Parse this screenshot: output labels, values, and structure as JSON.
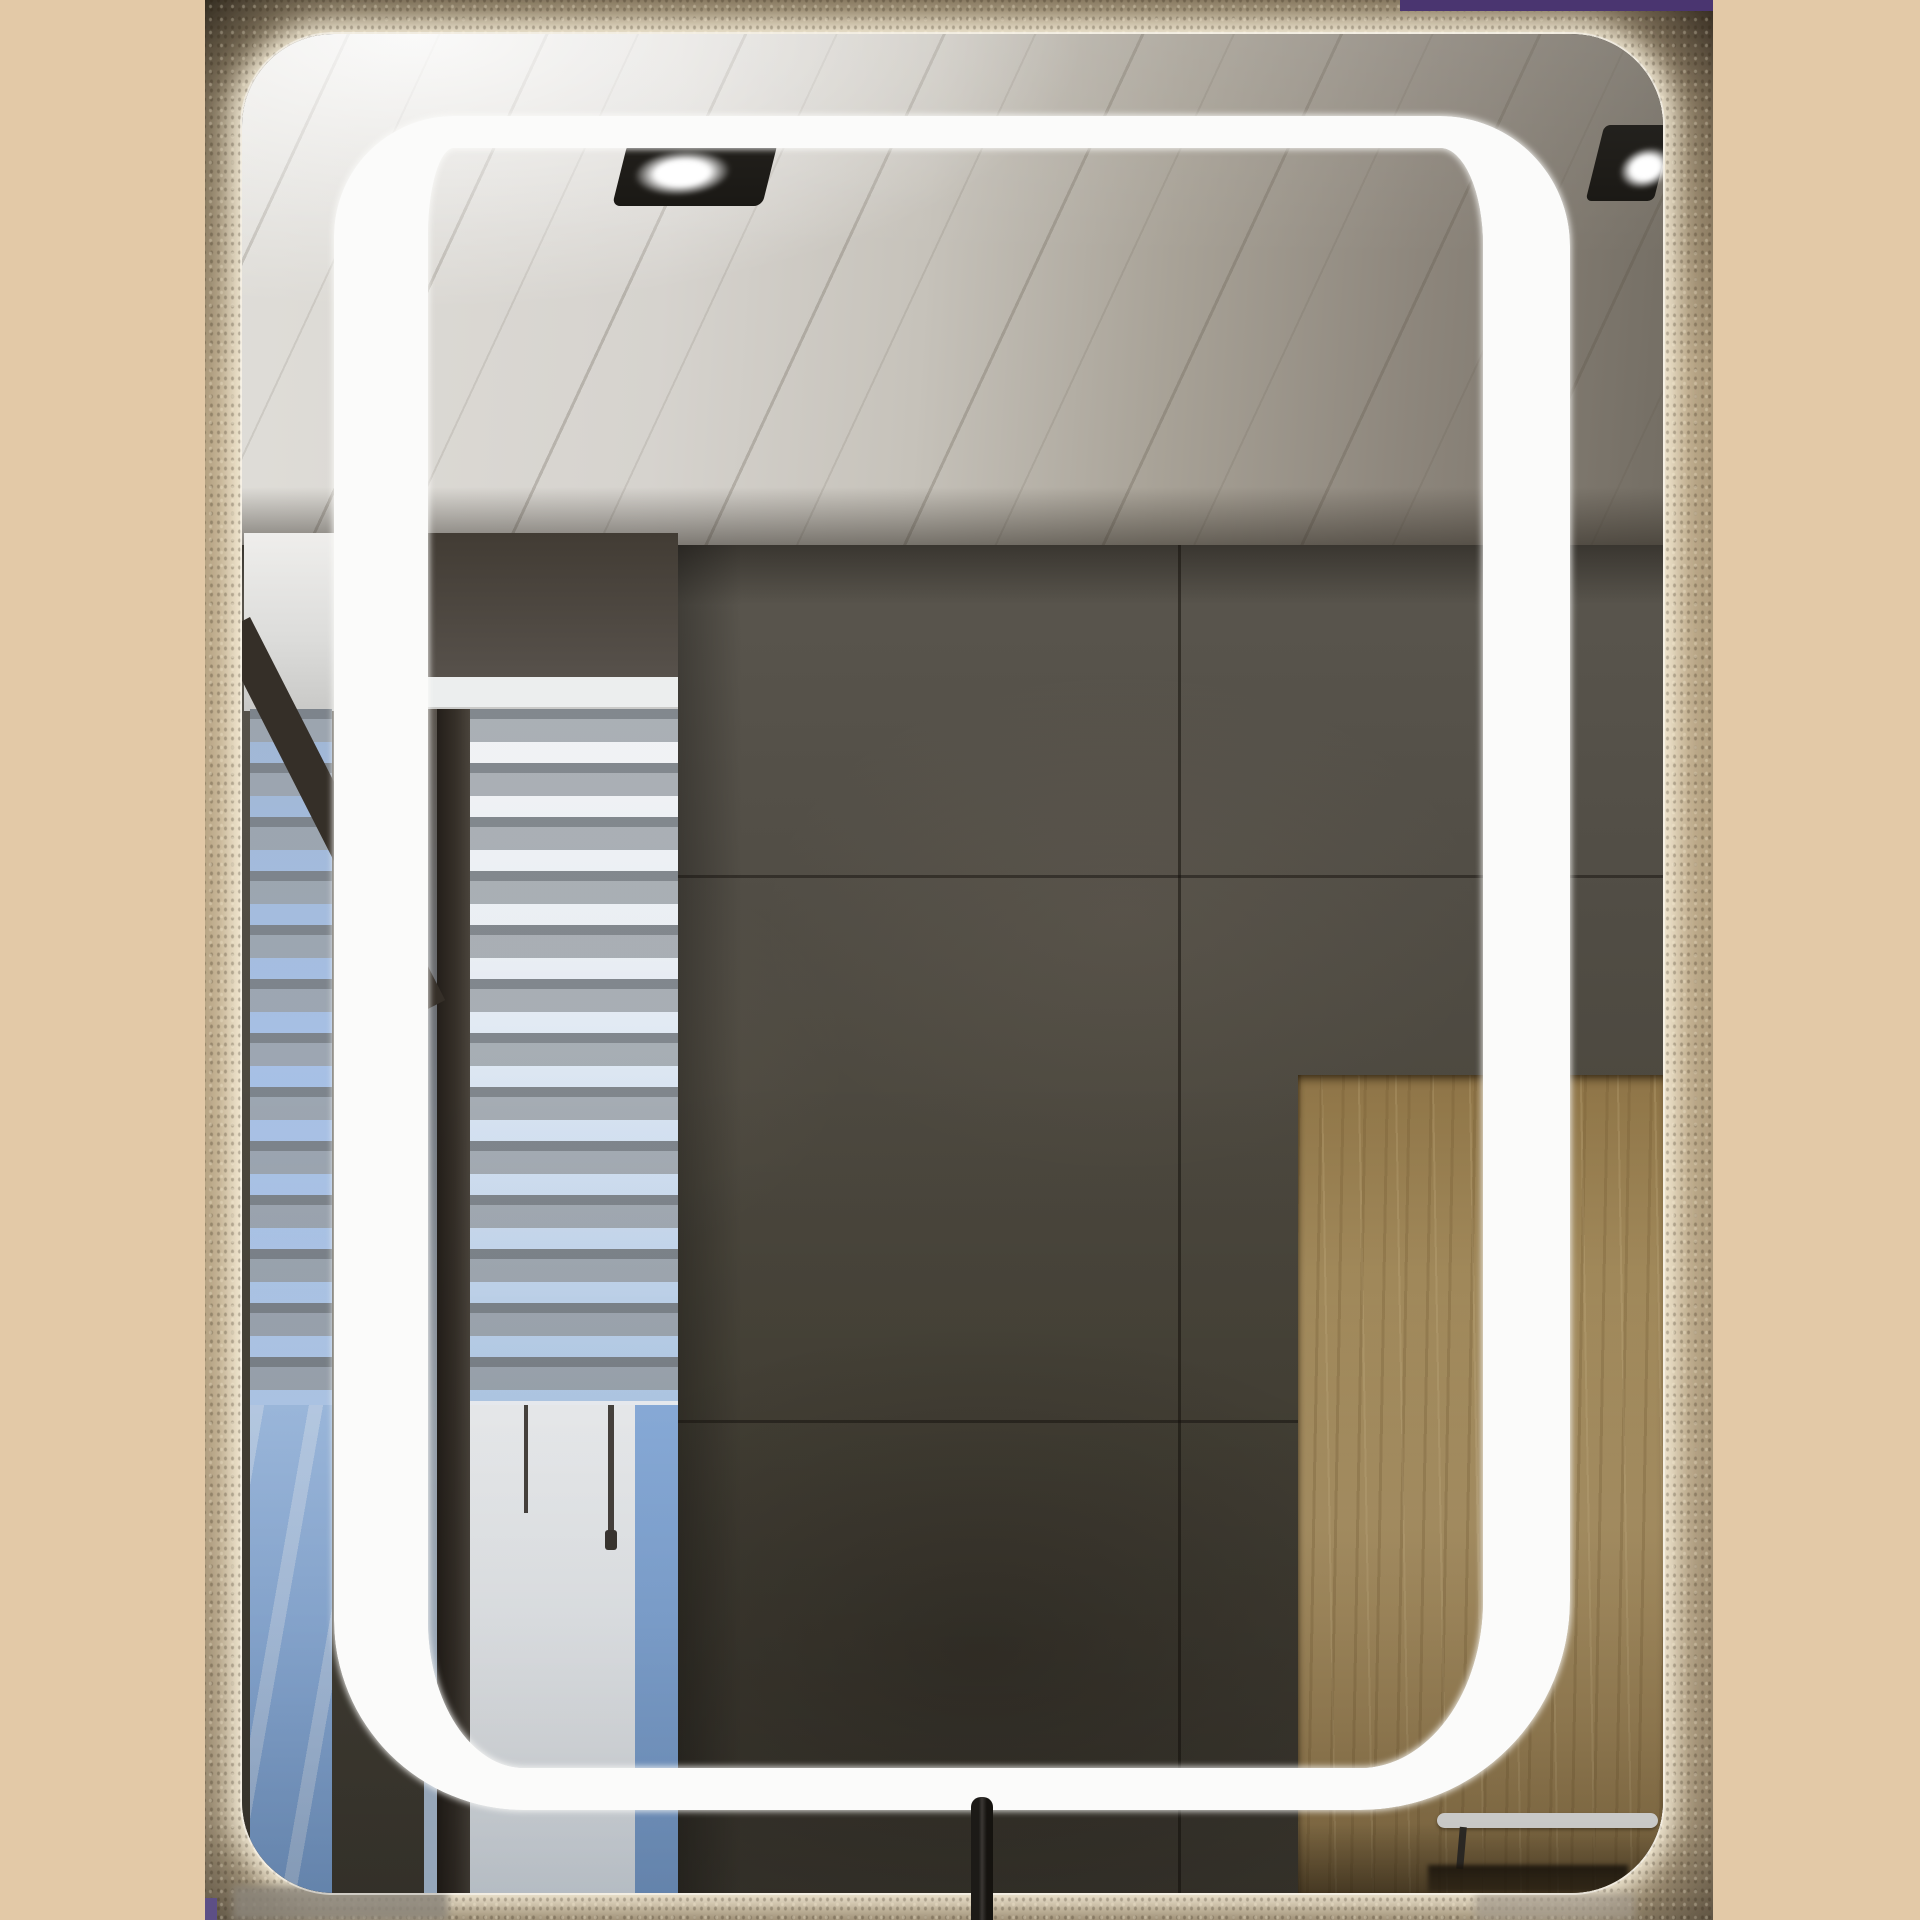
{
  "meta": {
    "kind": "product-photo",
    "subject": "Rectangular back-lit LED bathroom mirror with inner LED strip frame, mounted on a textured stone wall",
    "canvas": "1920x1920"
  },
  "palette": {
    "beige": "#e3c9a7",
    "wall-base": "#8a7a63",
    "wall-dark": "#30291f",
    "glow": "#f6ecd2",
    "purple": "#4a3570",
    "ceiling-light": "#dfddd8",
    "ceiling-dark": "#746e64",
    "tile-top": "#5a564e",
    "tile-bottom": "#403c33",
    "led": "#fbfbfa",
    "sky-top": "#a9c8ec",
    "sky-bottom": "#7da4d6",
    "slat-gray": "#80868c",
    "frame-dark": "#352f28",
    "wood": "#a78e5e",
    "wood-dark": "#8f7549",
    "towel": "#f3f3f1",
    "faucet": "#15130f"
  },
  "scene": {
    "background": "plain beige side columns",
    "photo": "bathroom photo strip, centered",
    "mirror": "rounded rectangular mirror with warm backlight halo on the wall",
    "led_frame": "white rounded LED strip frame inside the mirror",
    "reflection": {
      "ceiling": "white painted plank ceiling with two recessed spotlights",
      "wall": "dark concrete tile wall with seams",
      "window": "window with white venetian blinds, dark frame bar and two hanging pull cords",
      "sky": "blue sky visible through the lower window glass",
      "wood_panel": "oak wood panel on the right",
      "towel_bar": "white towel bar with dark shadow below"
    },
    "foreground": "black faucet stem at bottom center, purple sliver of original photo at top right"
  }
}
